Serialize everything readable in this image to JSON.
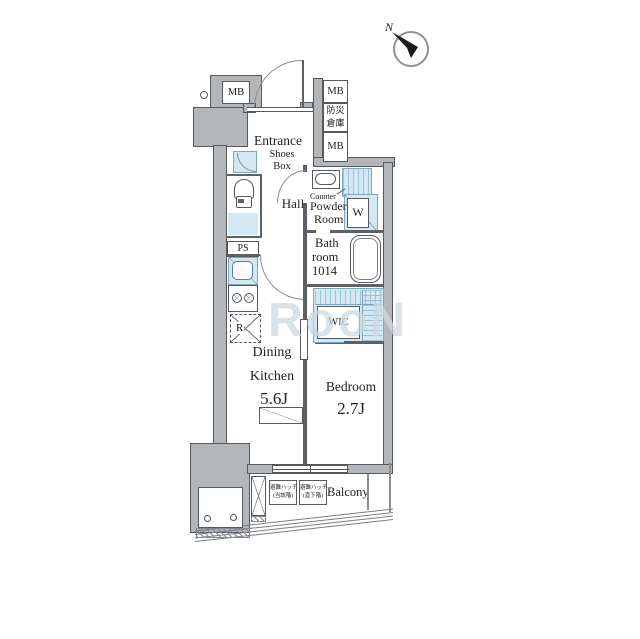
{
  "title": "Apartment floor plan",
  "compass": {
    "north_label": "N"
  },
  "watermark": "RooN",
  "colors": {
    "wall_fill": "#b3b7ba",
    "outline": "#55585c",
    "water_blue": "#d3e8f3",
    "text": "#222222"
  },
  "labels": {
    "mb_top_left": "MB",
    "mb_right_top": "MB",
    "disaster_storage_line1": "防災",
    "disaster_storage_line2": "倉庫",
    "mb_right_bottom": "MB",
    "entrance": "Entrance",
    "shoes_box_line1": "Shoes",
    "shoes_box_line2": "Box",
    "hall": "Hall",
    "counter": "Counter",
    "powder_room_line1": "Powder",
    "powder_room_line2": "Room",
    "washer": "W",
    "bathroom_line1": "Bath",
    "bathroom_line2": "room",
    "bathroom_line3": "1014",
    "pipe_space": "PS",
    "refrigerator": "R",
    "wic": "WIC",
    "dk_line1": "Dining",
    "dk_line2": "Kitchen",
    "dk_size": "5.6J",
    "bedroom": "Bedroom",
    "bedroom_size": "2.7J",
    "balcony": "Balcony",
    "hatch_current_line1": "避難ハッチ",
    "hatch_current_line2": "(当該階)",
    "hatch_below_line1": "避難ハッチ",
    "hatch_below_line2": "(直下階)"
  }
}
